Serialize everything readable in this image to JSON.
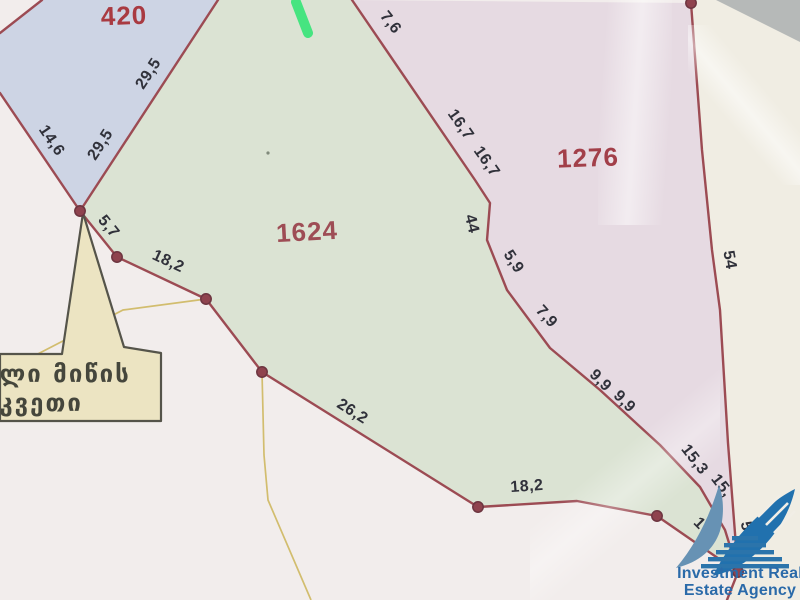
{
  "map": {
    "description_label": "scanned cadastral parcel plan",
    "parcels": [
      {
        "number": "420",
        "x": 124,
        "y": 16,
        "rot": -2,
        "number_color": "#a93a41",
        "fill": "#cdd4e4"
      },
      {
        "number": "1624",
        "x": 307,
        "y": 232,
        "rot": -3,
        "number_color": "#9e4d55",
        "fill": "#dbe3d3"
      },
      {
        "number": "1276",
        "x": 588,
        "y": 158,
        "rot": -2,
        "number_color": "#a23f49",
        "fill": "#e6dae2"
      }
    ],
    "edge_labels": [
      {
        "text": "14,6",
        "x": 51,
        "y": 141,
        "rot": 56
      },
      {
        "text": "29,5",
        "x": 101,
        "y": 145,
        "rot": -57
      },
      {
        "text": "29,5",
        "x": 149,
        "y": 74,
        "rot": -57
      },
      {
        "text": "5,7",
        "x": 108,
        "y": 227,
        "rot": 51
      },
      {
        "text": "18,2",
        "x": 168,
        "y": 262,
        "rot": 25
      },
      {
        "text": "26,2",
        "x": 352,
        "y": 412,
        "rot": 32
      },
      {
        "text": "18,2",
        "x": 527,
        "y": 487,
        "rot": -4
      },
      {
        "text": "7,6",
        "x": 390,
        "y": 23,
        "rot": 52
      },
      {
        "text": "16,7",
        "x": 460,
        "y": 125,
        "rot": 55
      },
      {
        "text": "16,7",
        "x": 486,
        "y": 162,
        "rot": 55
      },
      {
        "text": "44",
        "x": 471,
        "y": 224,
        "rot": 76
      },
      {
        "text": "5,9",
        "x": 513,
        "y": 262,
        "rot": 57
      },
      {
        "text": "7,9",
        "x": 546,
        "y": 317,
        "rot": 48
      },
      {
        "text": "9,9",
        "x": 600,
        "y": 381,
        "rot": 45
      },
      {
        "text": "9,9",
        "x": 624,
        "y": 402,
        "rot": 45
      },
      {
        "text": "15,3",
        "x": 694,
        "y": 460,
        "rot": 52
      },
      {
        "text": "15,",
        "x": 721,
        "y": 486,
        "rot": 52
      },
      {
        "text": "10,",
        "x": 704,
        "y": 529,
        "rot": 45
      },
      {
        "text": "51,2",
        "x": 748,
        "y": 538,
        "rot": 78
      },
      {
        "text": "54",
        "x": 729,
        "y": 260,
        "rot": 80
      }
    ]
  },
  "callout": {
    "line1": "ილი მიწის",
    "line2": "აკვეთი"
  },
  "logo": {
    "line1": "Investment Real",
    "line2": "Estate Agency"
  },
  "colors": {
    "paper": "#f2edec",
    "paper_right_cream": "#f0ede3",
    "fold_gray": "#b6b9b8",
    "boundary_red": "#9c4b53",
    "vertex_dot": "#8f434e",
    "yellow_line": "#d2bd6e",
    "highlight_green": "#3ae579",
    "callout_fill": "#ece4c2",
    "callout_border": "#55544a",
    "logo_blue_dark": "#2171ae",
    "logo_blue_light": "#6792b4",
    "logo_text_blue": "#2a6aa9"
  }
}
